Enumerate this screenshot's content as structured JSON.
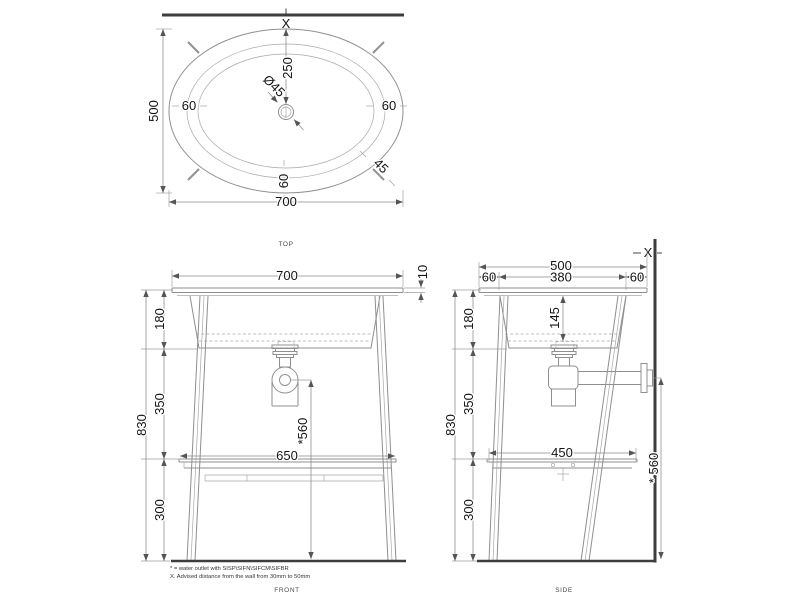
{
  "drawing": {
    "views": {
      "top": {
        "label": "TOP",
        "wall_marker": "X",
        "dims": {
          "width": "700",
          "depth": "500",
          "rim_left": "60",
          "rim_right": "60",
          "rim_bottom": "60",
          "drain_from_wall": "250",
          "drain_diameter": "Ø45",
          "corner_angle": "45"
        }
      },
      "front": {
        "label": "FRONT",
        "dims": {
          "width": "700",
          "top_thickness": "10",
          "section_top": "180",
          "section_mid": "350",
          "section_bottom": "300",
          "total_height": "830",
          "shelf_width": "650",
          "outlet_height": "*560"
        }
      },
      "side": {
        "label": "SIDE",
        "wall_marker": "X",
        "dims": {
          "depth": "500",
          "inner_depth": "380",
          "rim_front": "60",
          "rim_back": "60",
          "basin_depth": "145",
          "section_top": "180",
          "section_mid": "350",
          "section_bottom": "300",
          "total_height": "830",
          "shelf_depth": "450",
          "outlet_height": "* 560"
        }
      }
    },
    "notes": [
      "* = water outlet with SISP\\SIFN\\SIFCM\\SIFBR",
      "X. Advised distance from the wall from 30mm to 50mm"
    ],
    "colors": {
      "line_gray": "#8f8f8f",
      "wall_dark": "#3d3d3d",
      "text": "#141414",
      "background": "#ffffff"
    }
  }
}
